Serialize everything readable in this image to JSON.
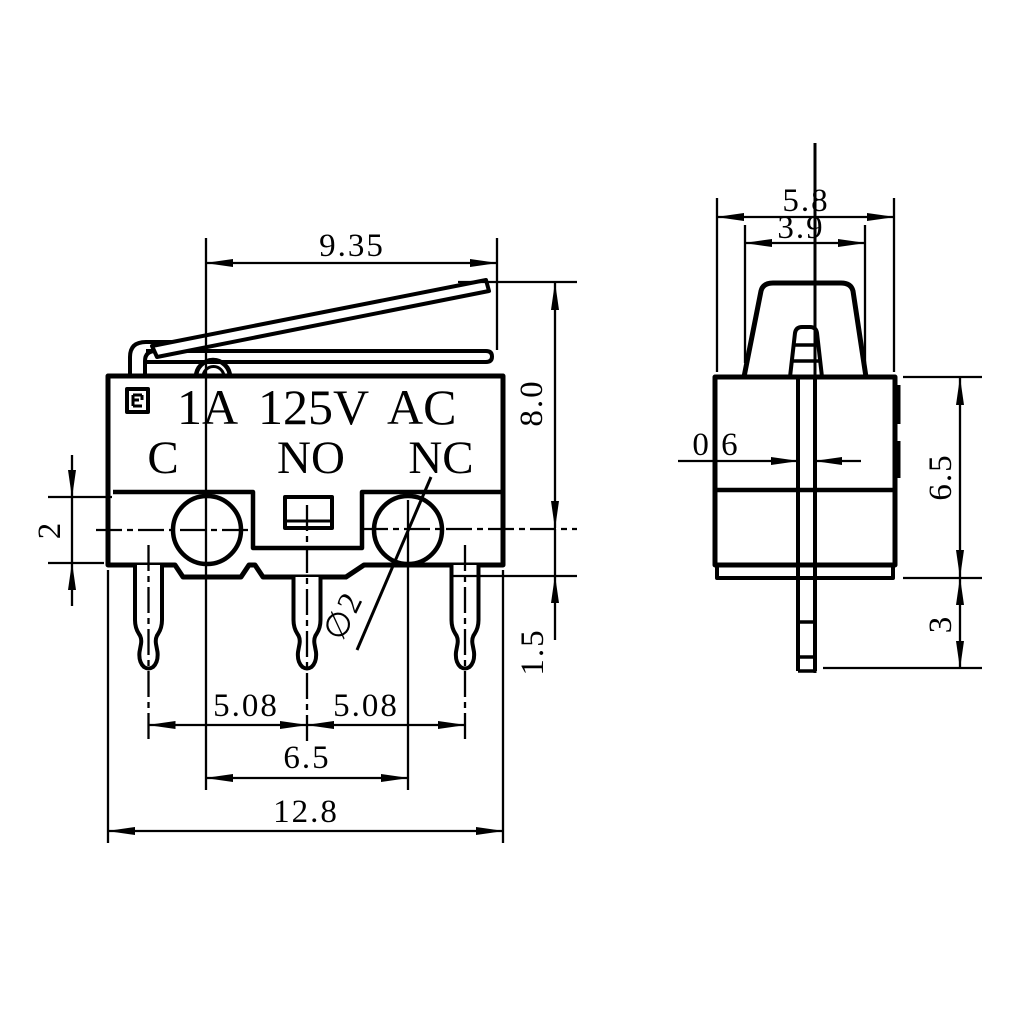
{
  "drawing": {
    "front_view": {
      "rating": {
        "current": "1A",
        "voltage": "125V",
        "circuit": "AC"
      },
      "terminals": {
        "common": "C",
        "normally_open": "NO",
        "normally_closed": "NC"
      },
      "dims": {
        "lever_reach": "9.35",
        "overall_height": "8.0",
        "flange_thickness": "2",
        "center_to_bottom": "1.5",
        "pin_pitch_left": "5.08",
        "pin_pitch_right": "5.08",
        "hole_pitch": "6.5",
        "body_width": "12.8",
        "hole_diameter": "∅2"
      }
    },
    "side_view": {
      "dims": {
        "body_depth": "5.8",
        "actuator_width": "3.9",
        "terminal_thickness": "0.6",
        "body_height": "6.5",
        "terminal_length": "3"
      }
    }
  }
}
